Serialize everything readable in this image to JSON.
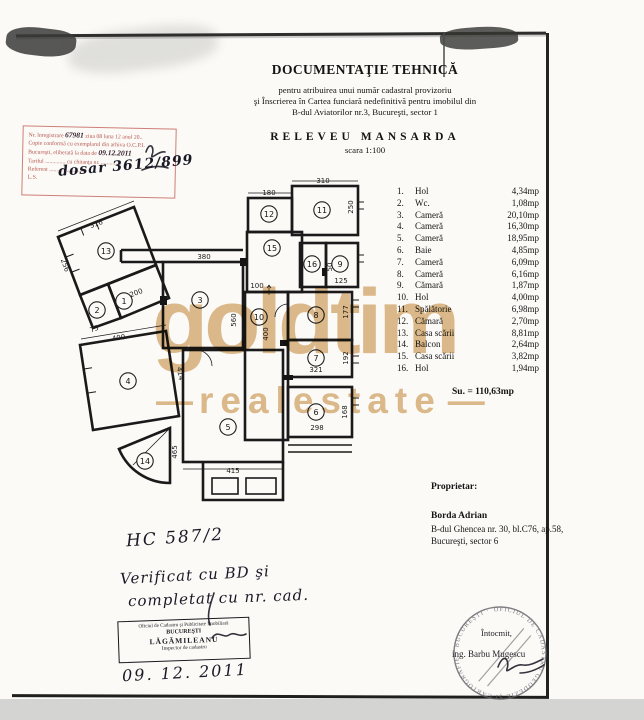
{
  "document": {
    "title": "DOCUMENTAŢIE TEHNICĂ",
    "subtitle1": "pentru atribuirea unui număr cadastral provizoriu",
    "subtitle2": "şi Înscrierea în Cartea funciară nedefinitivă pentru imobilul din",
    "subtitle3": "B-dul Aviatorilor nr.3, Bucureşti, sector 1",
    "drawing_title": "RELEVEU MANSARDA",
    "scale": "scara 1:100"
  },
  "registry_stamp": {
    "l1_label": "Nr. înregistrare",
    "l1_no": "67981",
    "l1_rest": "ziua 08 luna 12 anul 20..",
    "l2": "Copie conformă cu exemplarul din arhiva O.C.P.I.",
    "l3_label": "Bucureşti, eliberată la data de",
    "l3_date": "09.12.2011",
    "l4": "Tariful .............. cu chitanţa nr. ..............",
    "l5": "Referent ..........................",
    "l6": "L.S.",
    "handwritten_note": "dosar 3612/899"
  },
  "room_list": {
    "rows": [
      {
        "no": "1.",
        "name": "Hol",
        "area": "4,34mp"
      },
      {
        "no": "2.",
        "name": "Wc.",
        "area": "1,08mp"
      },
      {
        "no": "3.",
        "name": "Cameră",
        "area": "20,10mp"
      },
      {
        "no": "4.",
        "name": "Cameră",
        "area": "16,30mp"
      },
      {
        "no": "5.",
        "name": "Cameră",
        "area": "18,95mp"
      },
      {
        "no": "6.",
        "name": "Baie",
        "area": "4,85mp"
      },
      {
        "no": "7.",
        "name": "Cameră",
        "area": "6,09mp"
      },
      {
        "no": "8.",
        "name": "Cameră",
        "area": "6,16mp"
      },
      {
        "no": "9.",
        "name": "Cămară",
        "area": "1,87mp"
      },
      {
        "no": "10.",
        "name": "Hol",
        "area": "4,00mp"
      },
      {
        "no": "11.",
        "name": "Spălătorie",
        "area": "6,98mp"
      },
      {
        "no": "12.",
        "name": "Cămară",
        "area": "2,70mp"
      },
      {
        "no": "13.",
        "name": "Casa scării",
        "area": "8,81mp"
      },
      {
        "no": "14.",
        "name": "Balcon",
        "area": "2,64mp"
      },
      {
        "no": "15.",
        "name": "Casa scării",
        "area": "3,82mp"
      },
      {
        "no": "16.",
        "name": "Hol",
        "area": "1,94mp"
      }
    ],
    "total": "Su. = 110,63mp"
  },
  "owner": {
    "heading": "Proprietar:",
    "name": "Borda Adrian",
    "address1": "B-dul Ghencea nr. 30, bl.C76, ap.58,",
    "address2": "Bucureşti, sector 6"
  },
  "watermark": {
    "line1": "goldtim",
    "line2": "realestate",
    "dash": "—",
    "color": "#d6ab70"
  },
  "handwritten": {
    "note1": "HC 587/2",
    "note2": "Verificat cu BD şi",
    "note3": "completat cu nr. cad.",
    "date": "09. 12. 2011"
  },
  "office_stamp": {
    "line1": "Oficiul de Cadastru şi Publicitate Imobiliară",
    "line2": "BUCUREŞTI",
    "line3": "LĂGĂMILEANU",
    "line4": "Inspector de cadastru"
  },
  "maker": {
    "label": "Întocmit,",
    "name": "ing. Barbu Mugescu",
    "ring_text": "OFICIUL DE CADASTRU GEODEZIE ŞI CARTOGRAFIE · BUCUREŞTI ·"
  },
  "plan": {
    "rooms": [
      {
        "n": "1",
        "x": 124,
        "y": 301
      },
      {
        "n": "2",
        "x": 97,
        "y": 310
      },
      {
        "n": "3",
        "x": 200,
        "y": 300
      },
      {
        "n": "4",
        "x": 128,
        "y": 381
      },
      {
        "n": "5",
        "x": 228,
        "y": 427
      },
      {
        "n": "6",
        "x": 316,
        "y": 412
      },
      {
        "n": "7",
        "x": 316,
        "y": 358
      },
      {
        "n": "8",
        "x": 316,
        "y": 315
      },
      {
        "n": "9",
        "x": 340,
        "y": 264
      },
      {
        "n": "10",
        "x": 259,
        "y": 317
      },
      {
        "n": "11",
        "x": 322,
        "y": 210
      },
      {
        "n": "12",
        "x": 269,
        "y": 214
      },
      {
        "n": "13",
        "x": 106,
        "y": 251
      },
      {
        "n": "14",
        "x": 145,
        "y": 461
      },
      {
        "n": "15",
        "x": 272,
        "y": 248
      },
      {
        "n": "16",
        "x": 312,
        "y": 264
      }
    ],
    "dims": [
      {
        "t": "316",
        "x": 97,
        "y": 226,
        "r": -21
      },
      {
        "t": "256",
        "x": 63,
        "y": 266,
        "r": 69
      },
      {
        "t": "200",
        "x": 137,
        "y": 295,
        "r": -21
      },
      {
        "t": "75",
        "x": 95,
        "y": 331,
        "r": -21
      },
      {
        "t": "400",
        "x": 119,
        "y": 340,
        "r": -9
      },
      {
        "t": "414",
        "x": 178,
        "y": 374,
        "r": 81
      },
      {
        "t": "465",
        "x": 177,
        "y": 452,
        "r": -90
      },
      {
        "t": "415",
        "x": 233,
        "y": 473,
        "r": 0
      },
      {
        "t": "380",
        "x": 204,
        "y": 259,
        "r": 0
      },
      {
        "t": "560",
        "x": 236,
        "y": 320,
        "r": -90
      },
      {
        "t": "180",
        "x": 269,
        "y": 195,
        "r": 0
      },
      {
        "t": "310",
        "x": 323,
        "y": 183,
        "r": 0
      },
      {
        "t": "250",
        "x": 353,
        "y": 207,
        "r": -90
      },
      {
        "t": "100",
        "x": 257,
        "y": 288,
        "r": 0
      },
      {
        "t": "400",
        "x": 268,
        "y": 334,
        "r": -90
      },
      {
        "t": "50",
        "x": 332,
        "y": 267,
        "r": -90
      },
      {
        "t": "125",
        "x": 341,
        "y": 283,
        "r": 0
      },
      {
        "t": "177",
        "x": 348,
        "y": 312,
        "r": -90
      },
      {
        "t": "192",
        "x": 348,
        "y": 358,
        "r": -90
      },
      {
        "t": "321",
        "x": 316,
        "y": 372,
        "r": 0
      },
      {
        "t": "298",
        "x": 317,
        "y": 430,
        "r": 0
      },
      {
        "t": "168",
        "x": 347,
        "y": 412,
        "r": -90
      }
    ]
  }
}
